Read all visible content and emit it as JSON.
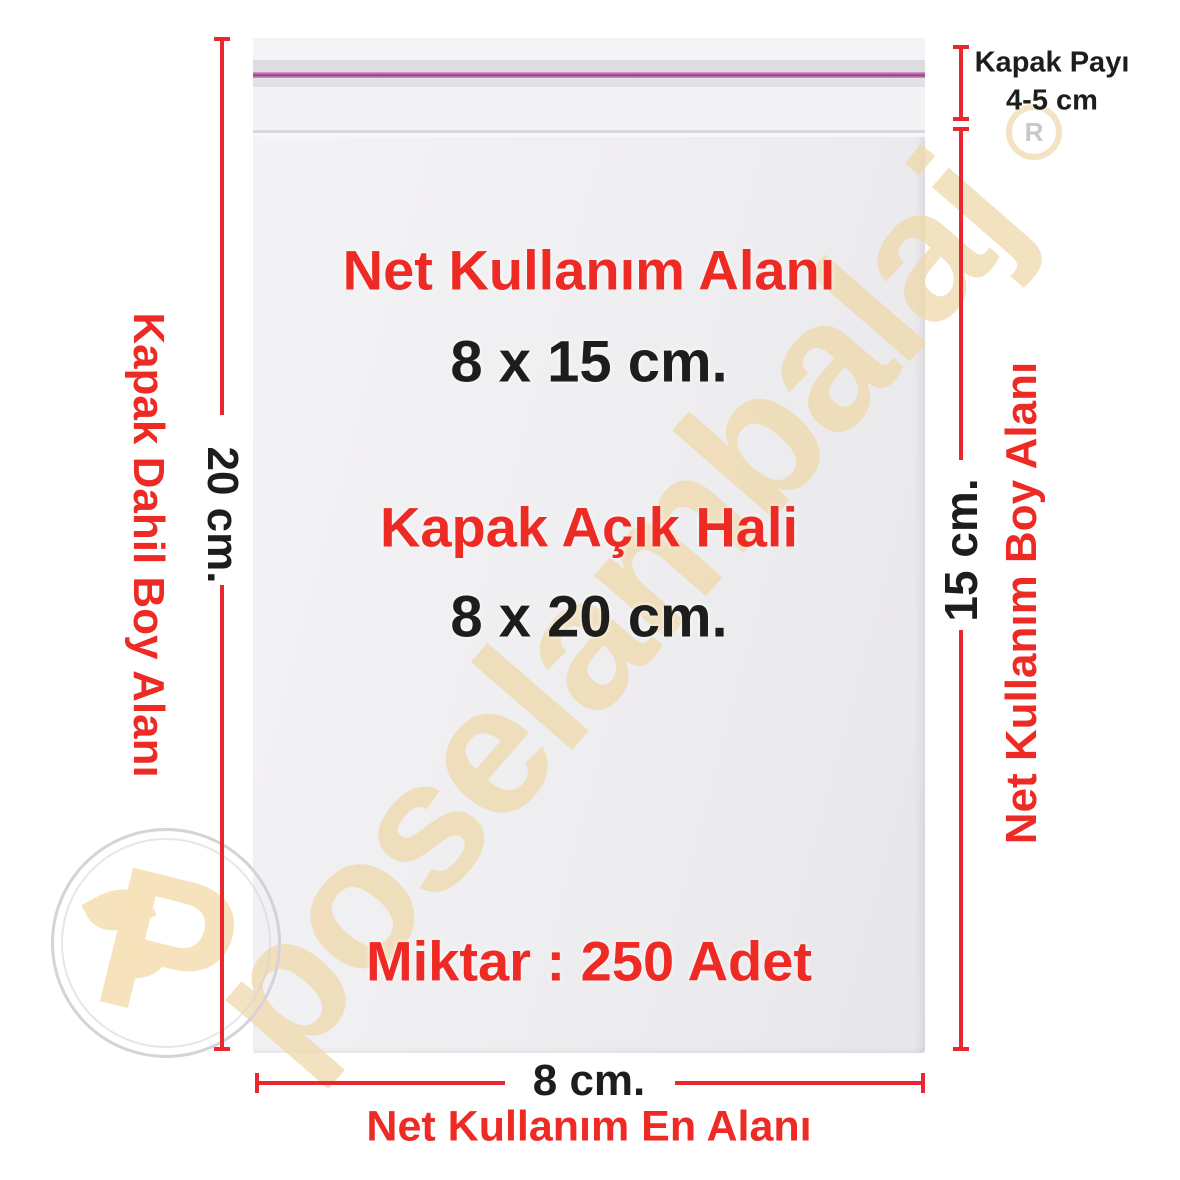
{
  "product_labels": {
    "usable_area_title": "Net Kullanım Alanı",
    "usable_area_size": "8 x 15 cm.",
    "open_flap_title": "Kapak Açık Hali",
    "open_flap_size": "8 x 20 cm.",
    "quantity": "Miktar : 250 Adet"
  },
  "measurements": {
    "flap": {
      "title": "Kapak Payı",
      "value": "4-5 cm"
    },
    "left": {
      "value": "20 cm.",
      "label": "Kapak Dahil Boy Alanı"
    },
    "right": {
      "value": "15 cm.",
      "label": "Net Kullanım Boy Alanı"
    },
    "bottom": {
      "value": "8 cm.",
      "label": "Net Kullanım En Alanı"
    }
  },
  "watermark": {
    "brand": "poselambalaj",
    "registered_mark": "R",
    "logo_initial": "P"
  },
  "colors": {
    "accent_red": "#e8282e",
    "text_red": "#ee2a24",
    "text_black": "#1d1d1b",
    "watermark_beige": "#efd8aa",
    "adhesive_pink": "#a84e98",
    "bag_gray": "#eeedf0"
  }
}
